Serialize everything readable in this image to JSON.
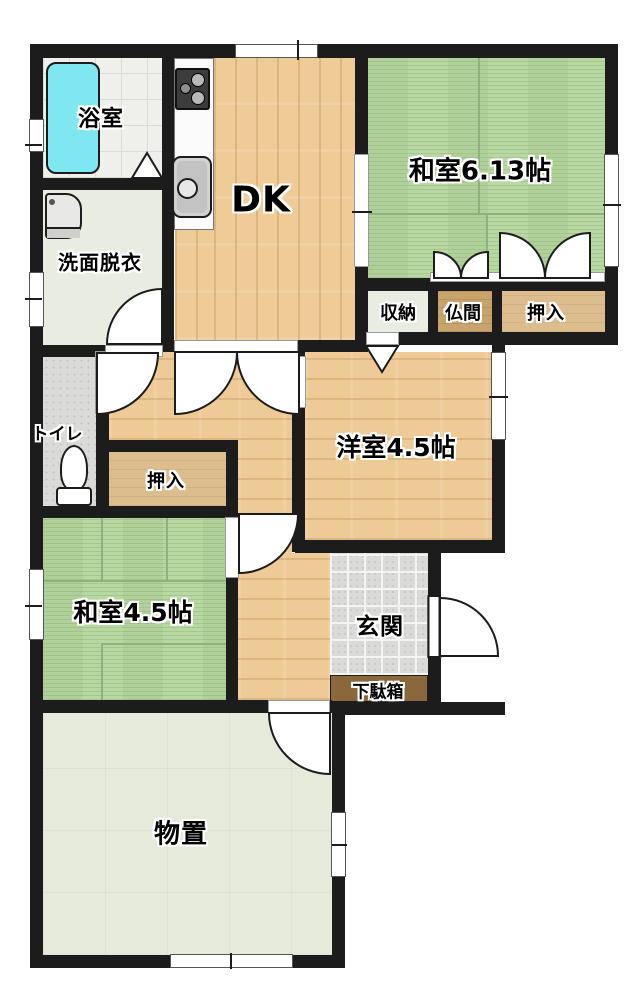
{
  "figure": {
    "type": "japanese-apartment-floor-plan"
  },
  "rooms": {
    "bathroom": {
      "label": "浴室"
    },
    "washroom": {
      "label": "洗面脱衣"
    },
    "toilet": {
      "label": "トイレ"
    },
    "dining_kitchen": {
      "label": "DK"
    },
    "japanese_room_6": {
      "label": "和室6.13帖"
    },
    "storage": {
      "label": "収納"
    },
    "altar_room": {
      "label": "仏間"
    },
    "closet_right": {
      "label": "押入"
    },
    "western_room": {
      "label": "洋室4.5帖"
    },
    "closet_left": {
      "label": "押入"
    },
    "japanese_room_45": {
      "label": "和室4.5帖"
    },
    "entrance": {
      "label": "玄関"
    },
    "shoe_cabinet": {
      "label": "下駄箱"
    },
    "storeroom": {
      "label": "物置"
    }
  },
  "fixtures": {
    "bathtub": "bathtub-icon",
    "gas_stove": "gas-stove-icon",
    "kitchen_sink": "kitchen-sink-icon",
    "washbasin": "washbasin-icon",
    "toilet_bowl": "toilet-bowl-icon"
  },
  "colors": {
    "wall": "#1c1c1c",
    "tatami_green": "#b7d8a0",
    "wood_floor": "#efcb98",
    "bathtub_cyan": "#7ee7f0",
    "entrance_tile": "#dadad8",
    "shoe_cabinet_brown": "#8a683c",
    "storeroom_sage": "#e5eadb",
    "background": "#ffffff"
  }
}
